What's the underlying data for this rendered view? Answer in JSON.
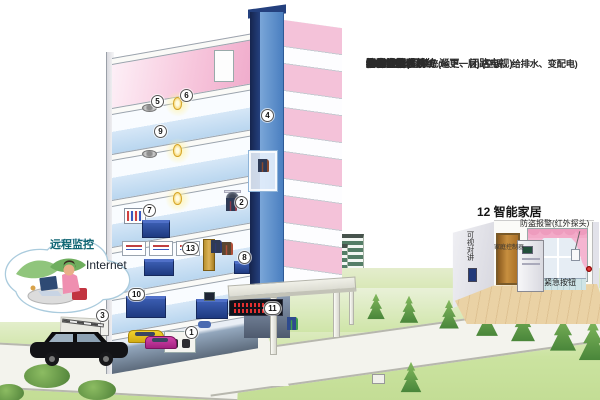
{
  "legend": {
    "items": [
      {
        "n": "1",
        "t": "楼宇控制管理系统(地下一层)  (空调、给排水、变配电)"
      },
      {
        "n": "2",
        "t": "综合保安(门禁、巡更、闭路电视)"
      },
      {
        "n": "3",
        "t": "停车场管理系统"
      },
      {
        "n": "4",
        "t": "电梯控制系统"
      },
      {
        "n": "5",
        "t": "公共广播系统"
      },
      {
        "n": "6",
        "t": "照明系统"
      },
      {
        "n": "7",
        "t": "消防报警系统"
      },
      {
        "n": "8",
        "t": "物业管理系统"
      },
      {
        "n": "9",
        "t": "办公自动化系统"
      },
      {
        "n": "10",
        "t": "信息资源"
      },
      {
        "n": "11",
        "t": "电子公告"
      },
      {
        "n": "12",
        "t": "智能家居"
      },
      {
        "n": "13",
        "t": "综合布线系统"
      }
    ]
  },
  "cloud": {
    "title": "远程监控",
    "network_label": "Internet"
  },
  "inset": {
    "title": "12 智能家居",
    "alarm_label": "防盗报警(红外探头)",
    "intercom_label": "可视对讲",
    "controller_label": "家庭控制器",
    "emergency_label": "紧急按钮"
  },
  "markers": {
    "m1": "1",
    "m2": "2",
    "m3": "3",
    "m4": "4",
    "m5": "5",
    "m6": "6",
    "m7": "7",
    "m8": "8",
    "m9": "9",
    "m10": "10",
    "m11": "11",
    "m13": "13"
  },
  "colors": {
    "wall_pink": "#f2b9d3",
    "shaft_blue": "#5b8fc9",
    "cabinet_navy": "#1e3a80",
    "lawn_green": "#cbe3a0",
    "led_red": "#e23030",
    "wood_floor": "#ead2a5"
  }
}
